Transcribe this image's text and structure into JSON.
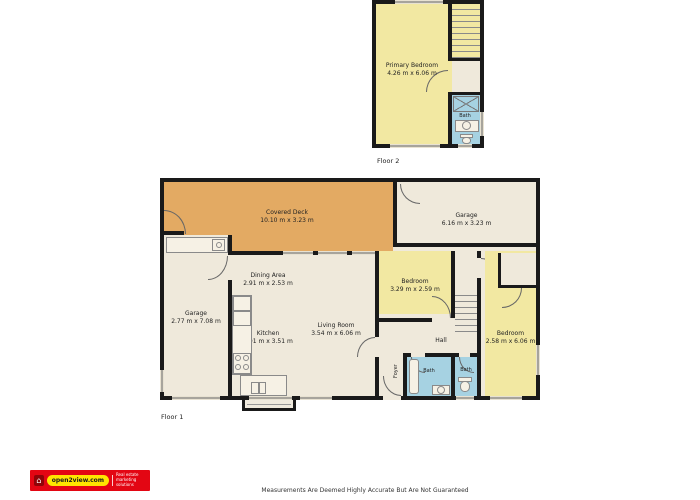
{
  "colors": {
    "wall": "#1a1a1a",
    "deck_orange": "#e3aa63",
    "room_yellow": "#f2e8a2",
    "floor_beige": "#efe9db",
    "bath_blue": "#a6d2e2",
    "logo_red": "#e30613",
    "logo_yellow": "#ffe500"
  },
  "floor2": {
    "label": "Floor 2",
    "primary_bedroom": {
      "name": "Primary Bedroom",
      "dims": "4.26 m x 6.06 m"
    },
    "bath": {
      "name": "Bath"
    }
  },
  "floor1": {
    "label": "Floor 1",
    "covered_deck": {
      "name": "Covered Deck",
      "dims": "10.10 m x 3.23 m"
    },
    "garage_top": {
      "name": "Garage",
      "dims": "6.16 m x 3.23 m"
    },
    "garage_left": {
      "name": "Garage",
      "dims": "2.77 m x 7.08 m"
    },
    "dining": {
      "name": "Dining Area",
      "dims": "2.91 m x 2.53 m"
    },
    "kitchen": {
      "name": "Kitchen",
      "dims": "2.91 m x 3.51 m"
    },
    "living": {
      "name": "Living Room",
      "dims": "3.54 m x 6.06 m"
    },
    "bedroom_small": {
      "name": "Bedroom",
      "dims": "3.29 m x 2.59 m"
    },
    "bedroom_right": {
      "name": "Bedroom",
      "dims": "2.58 m x 6.06 m"
    },
    "hall": {
      "name": "Hall"
    },
    "foyer": {
      "name": "Foyer"
    },
    "bath_main": {
      "name": "Bath"
    },
    "bath_wc": {
      "name": "Bath"
    }
  },
  "footer": {
    "logo_text": "open2view.com",
    "tagline": "Real estate marketing solutions",
    "disclaimer": "Measurements Are Deemed Highly Accurate But Are Not Guaranteed"
  }
}
